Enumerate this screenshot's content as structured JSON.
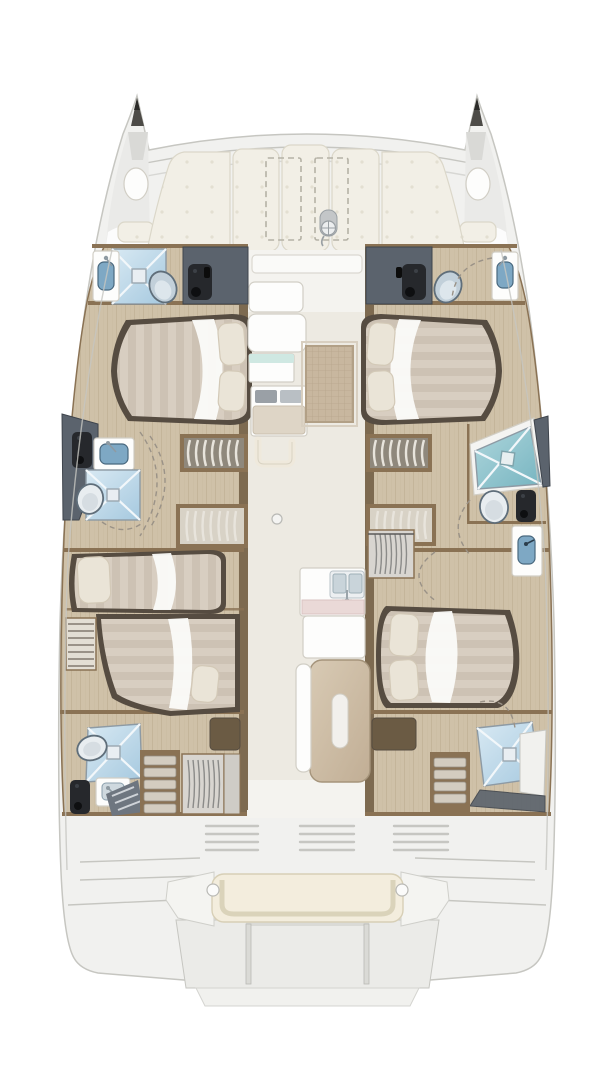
{
  "document": {
    "description": "Top-view accommodation floor plan of a sailing catamaran (bow up, stern down); purely graphical, no visible text labels"
  },
  "colors": {
    "page_bg": "#ffffff",
    "hull_deck": "#f1f1ef",
    "hull_line": "#c6c6c1",
    "deck_inner": "#eaeae8",
    "deck_shade": "#d2d2cf",
    "bow_tip": "#4d4b47",
    "bow_tip_deep": "#2c2b29",
    "cushion": "#f2efe6",
    "cushion_line": "#dbd7c9",
    "cushion_dot": "#e3dfd1",
    "hatch_dash": "#b5b2a6",
    "wood_floor": "#cfc1a8",
    "wood_line": "#b9a98c",
    "wall_brown": "#7d6a50",
    "bulkhead": "#8a7254",
    "cabinet_dark": "#6b5b44",
    "bed_frame": "#564c41",
    "mattress": "#d8cec1",
    "mattress_stripe": "#c7bbac",
    "duvet": "#fbfbf9",
    "pillow": "#eae4d7",
    "pillow_line": "#d3c9b7",
    "wet_dark": "#5b636d",
    "wet_line": "#3f454d",
    "fixture_black": "#26282c",
    "shower_light": "#d8e9f3",
    "shower_blue": "#a6c9df",
    "shower_x": "#f2f7fa",
    "shower_line": "#8d9aa4",
    "teal_light": "#aed6dc",
    "teal": "#76b4c0",
    "toilet_body": "#c2d0da",
    "toilet_light": "#e8edf0",
    "toilet_line": "#5f6e7a",
    "sink_blue": "#7ea8c4",
    "sink_line": "#49687e",
    "fix_white": "#fdfdfc",
    "furn_line": "#d1cec5",
    "salon_floor": "#edeae2",
    "salon_front": "#f4f3ef",
    "glass_teal": "#cfe8e2",
    "marble": "#ead9d7",
    "marble_line": "#d9c4c2",
    "island_a": "#d8cab4",
    "island_b": "#c1ae95",
    "island_line": "#a5947b",
    "island_handle": "#f2f0ec",
    "rug": "#c8b79f",
    "rug_line": "#b2a086",
    "bench_cream": "#f3eddd",
    "bench_line": "#d7cfb6",
    "vent_line": "#c6c6c2",
    "tread": "#d3ccc0",
    "tread_line": "#968e82",
    "tread_light": "#e8e4dc",
    "steps_bg": "#8f887c",
    "steps_dark": "#6e7680",
    "hanger": "#8b8b89",
    "door_dash": "#9a9287"
  },
  "plan": {
    "orientation": "bow-up",
    "foredeck": {
      "sunpad_panels": 5,
      "deck_hatches": 2,
      "windlass": 1,
      "bow_seats": 2,
      "bow_hatches": 2
    },
    "port_hull": {
      "bow_head": [
        "sink",
        "shower",
        "toilet",
        "black-fixture",
        "dark-locker"
      ],
      "forward_cabin": {
        "bed": "double",
        "pillows": 2,
        "companionway_steps": true,
        "drawer_unit": true
      },
      "mid_head": [
        "black-fixture",
        "sink",
        "shower",
        "toilet"
      ],
      "aft_cabin": {
        "beds": "two-singles",
        "pillows": 2,
        "ladder": true
      },
      "aft_head": [
        "shower",
        "toilet",
        "sink",
        "black-fixture",
        "hatch-steps"
      ],
      "aft_utilities": [
        "companionway-steps",
        "wardrobe",
        "dark-locker"
      ]
    },
    "starboard_hull": {
      "bow_head": [
        "dark-locker",
        "black-fixture",
        "toilet",
        "sink"
      ],
      "forward_cabin": {
        "bed": "double",
        "pillows": 2,
        "companionway_steps": true,
        "drawer_unit": true
      },
      "mid_head": [
        "teal-shower",
        "toilet",
        "black-fixture",
        "sink-compartment"
      ],
      "aft_cabin": {
        "bed": "double",
        "pillows": 2,
        "wardrobe": true,
        "dark-locker": true
      },
      "aft_head": [
        "shower",
        "steps",
        "white-floor"
      ]
    },
    "saloon": {
      "furniture": [
        "forward-sofa",
        "glass-top-unit",
        "chart-desk",
        "grab-handle",
        "woven-rug",
        "ceiling-light"
      ],
      "galley": [
        "double-sink",
        "faucet",
        "marble-strip",
        "counter",
        "island-with-handle",
        "side-panel"
      ]
    },
    "aft_deck": {
      "features": [
        "engine-vent-lines",
        "side-steps",
        "bench-seat",
        "bench-knobs",
        "transom-recess",
        "gate-posts",
        "swim-platform"
      ]
    }
  }
}
